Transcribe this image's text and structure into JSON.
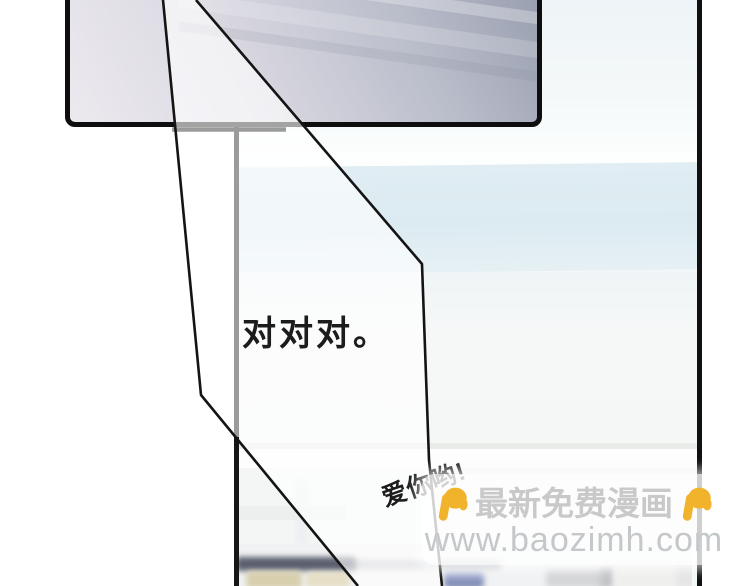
{
  "page": {
    "kind": "comic-page",
    "background_color": "#ffffff"
  },
  "speech": {
    "affirmation": "对对对。",
    "love": "爱你哟!"
  },
  "watermark": {
    "site_label": "最新免费漫画",
    "site_url": "www.baozimh.com",
    "text_color": "#c9c9c9",
    "url_color": "#c5c8ca",
    "box_color": "rgba(255,255,255,0.8)",
    "hand_icon": "pointing-down-hand-icon",
    "hand_color": "#F2B32C"
  },
  "artwork": {
    "panel_top": {
      "border_color": "#0e0e0e",
      "gradient_light": "#ece9ef",
      "gradient_dark": "#989eaf"
    },
    "panel_right": {
      "border_color": "#101010",
      "background": "#f3f7f8",
      "wall_band_color": "#dcebf2"
    },
    "frame_line_gray": "#9b9b9b",
    "tail_line_color": "#141414"
  }
}
